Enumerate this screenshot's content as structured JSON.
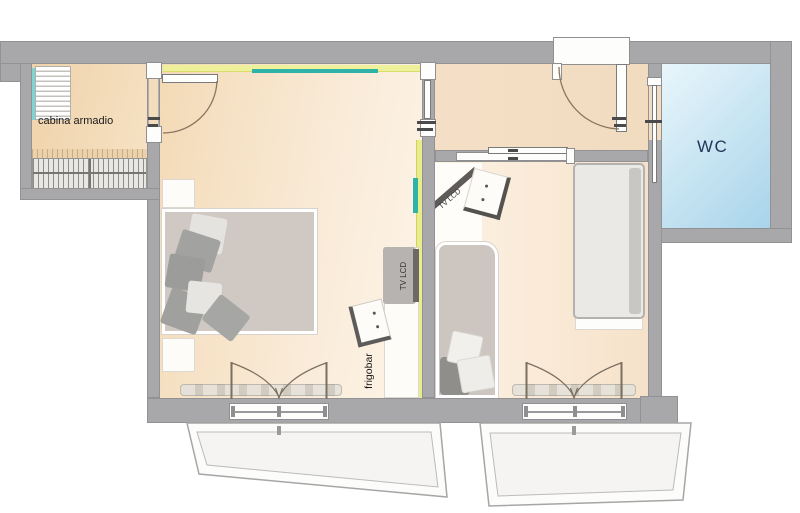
{
  "title": "hotel suite floor plan",
  "labels": {
    "closet": "cabina armadio",
    "wc": "WC",
    "minibar": "frigobar",
    "tv_room1": "TV LCD",
    "tv_room2": "TV LCD"
  },
  "colors": {
    "wall": "#a8a8aa",
    "room1_floor_dark": "#f3dab6",
    "room1_floor_light": "#fdf4e8",
    "room2_floor_light": "#fdf2e4",
    "room2_floor_dark": "#f6e2ca",
    "closet_floor": "#f2d8b4",
    "wc_fill_light": "#e9f6fb",
    "wc_fill_dark": "#a8d4ea",
    "wc_text": "#25365a",
    "accent_yellow": "#eef19a",
    "accent_teal": "#2fb3a8",
    "bed_gray": "#cfc8c3",
    "pillow_dark": "#a2a2a0",
    "pillow_light": "#e5e3e0",
    "door_arc": "#8a7560"
  }
}
